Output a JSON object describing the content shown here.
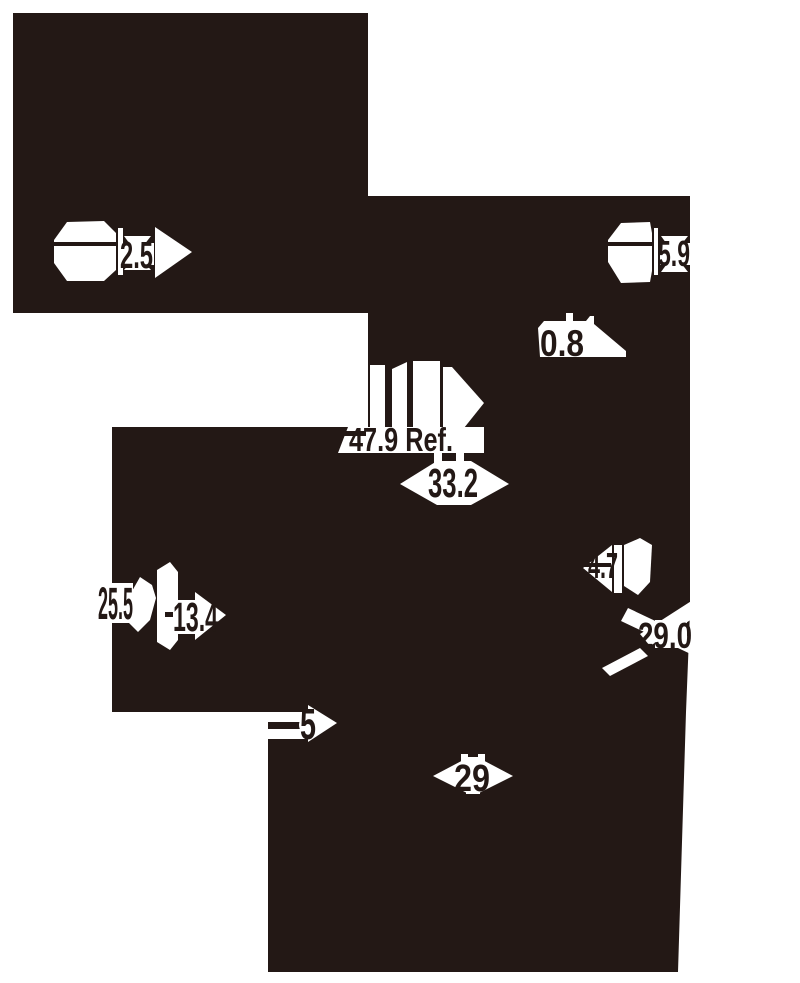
{
  "drawing": {
    "type": "technical-dimension-drawing",
    "colors": {
      "ink": "#231815",
      "background": "#ffffff"
    },
    "dimensions": {
      "left_hex": "2.5",
      "right_hex": "5.9",
      "chamfer": "0.8",
      "overall_length_ref": "47.9 Ref.",
      "body_width": "33.2",
      "tab_height": "4.7",
      "flange_width": "29.0",
      "upper_left": "25.5",
      "lower_left": "13.4",
      "step_depth": "5",
      "bottom_width": "29"
    }
  }
}
